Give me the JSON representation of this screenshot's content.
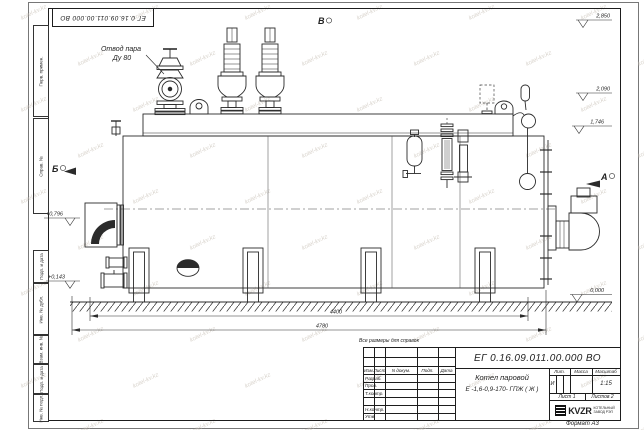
{
  "sheet": {
    "format": "Формат А3",
    "note": "Все размеры для справок"
  },
  "title_block": {
    "doc_number": "ЕГ 0.16.09.011.00.000  ВО",
    "name_line1": "Котел паровой",
    "name_line2": "Е -1,6-0,9-170- ГПЖ ( Ж )",
    "col_izm": "Изм.",
    "col_list": "Лист",
    "col_doc": "N докум.",
    "col_podp": "Подп.",
    "col_data": "Дата",
    "row_razrab": "Разраб.",
    "row_prov": "Пров.",
    "row_tkontr": "Т.контр.",
    "row_nkontr": "Н.контр.",
    "row_utv": "Утв.",
    "lit_header": "Лит.",
    "lit_value": "И",
    "mass_header": "Масса",
    "scale_header": "Масштаб",
    "scale_value": "1:15",
    "sheet_info": "Лист 1",
    "sheets_info": "Листов 2",
    "company_logo": "KVZR",
    "company_line1": "КОТЕЛЬНЫЙ",
    "company_line2": "ЗАВОД РЭП"
  },
  "margin_labels": [
    "Перв. примен.",
    "Справ. №",
    "Подп. и дата",
    "Инв. № дубл.",
    "Взам. инв. №",
    "Подп. и дата",
    "Инв. № подл."
  ],
  "annotations": {
    "steam_outlet_line1": "Отвод пара",
    "steam_outlet_line2": "Ду 80",
    "view_a": "А",
    "view_b": "Б",
    "view_v": "В",
    "dim_inner": "4400",
    "dim_overall": "4780",
    "el_2850": "2,850",
    "el_2090": "2,090",
    "el_1746": "1,746",
    "el_0796": "+0,796",
    "el_0143": "+0,143",
    "el_0000": "0,000"
  },
  "watermark": {
    "text": "kotel-kv.kz"
  },
  "colors": {
    "line": "#2b2b2b",
    "watermark": "#c9c2b8"
  }
}
